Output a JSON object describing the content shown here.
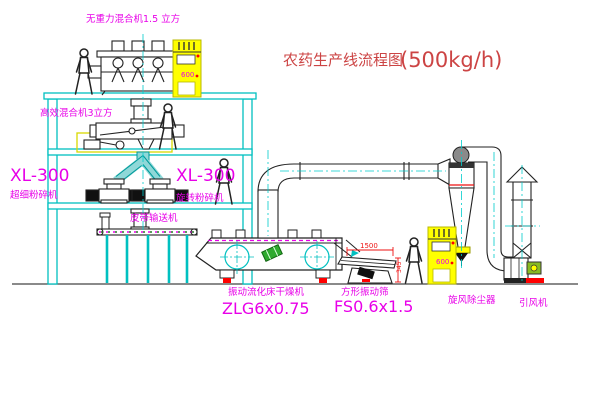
{
  "title": {
    "text": "农药生产线流程图",
    "capacity": "(500kg/h)"
  },
  "equipment": {
    "top_mixer": {
      "label": "无重力混合机1.5 立方"
    },
    "floor_mixer": {
      "label": "高效混合机3立方"
    },
    "mill_left": {
      "model": "XL-300",
      "name": "超细粉碎机"
    },
    "mill_right": {
      "model": "XL-300",
      "name": "旋转粉碎机"
    },
    "belt_conveyor": {
      "name": "皮带输送机"
    },
    "dryer": {
      "name": "振动流化床干燥机",
      "model": "ZLG6x0.75"
    },
    "sieve": {
      "name": "方形振动筛",
      "model": "FS0.6x1.5",
      "dim_width": "1500",
      "dim_height": "345"
    },
    "cyclone": {
      "name": "旋风除尘器"
    },
    "fan": {
      "name": "引风机"
    },
    "control_cabinet": {
      "panel_text": "600"
    }
  },
  "colors": {
    "structure_cyan": "#00c0c0",
    "machine_black": "#222222",
    "label_magenta": "#e800e8",
    "title_red": "#cc4444",
    "cabinet_yellow": "#ffff00",
    "alert_red": "#ff0000",
    "motor_green": "#2faa2f"
  }
}
